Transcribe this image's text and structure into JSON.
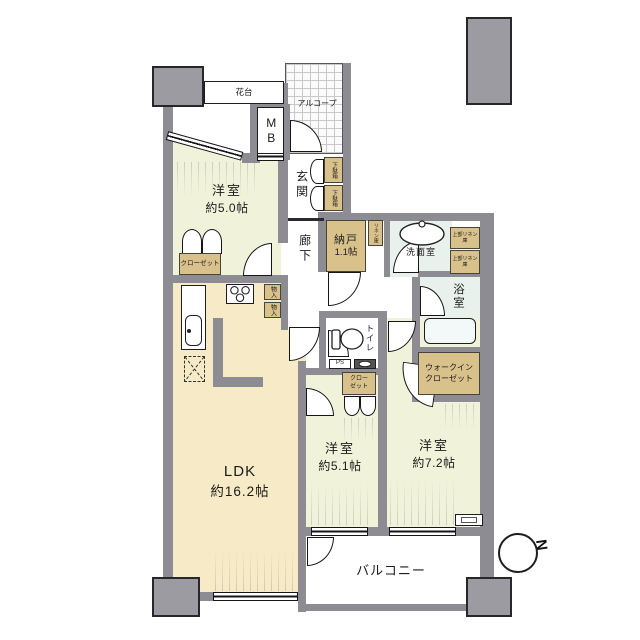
{
  "floorplan": {
    "rooms": {
      "western_5_0": {
        "label": "洋室",
        "size": "約5.0帖"
      },
      "western_5_1": {
        "label": "洋室",
        "size": "約5.1帖"
      },
      "western_7_2": {
        "label": "洋室",
        "size": "約7.2帖"
      },
      "ldk": {
        "label": "LDK",
        "size": "約16.2帖"
      },
      "storage_room": {
        "label": "納戸",
        "size": "1.1帖"
      },
      "entrance": {
        "label": "玄関"
      },
      "corridor": {
        "label": "廊下"
      },
      "washroom": {
        "label": "洗面室"
      },
      "bathroom": {
        "label": "浴室"
      },
      "toilet": {
        "label": "トイレ"
      },
      "balcony": {
        "label": "バルコニー"
      },
      "alcove": {
        "label": "アルコープ"
      },
      "flower_stand": {
        "label": "花台"
      },
      "meter_box": {
        "label": "MB"
      },
      "walk_in_closet": {
        "line1": "ウォークイン",
        "line2": "クローゼット"
      },
      "closet_5_0": {
        "label": "クローゼット"
      },
      "closet_5_1": {
        "line1": "クロー",
        "line2": "ゼット"
      },
      "shoe_box": {
        "label": "下駄箱"
      },
      "storage_small": {
        "label": "物入"
      },
      "linen": {
        "label": "リネン庫"
      },
      "upper_linen": {
        "line1": "上部リネン",
        "line2": "庫"
      },
      "pipe_space": {
        "label": "PS"
      }
    },
    "compass": {
      "north": "N"
    },
    "colors": {
      "wall": "#8c8c92",
      "bedroom": "#f0f3da",
      "ldk": "#f6ebc6",
      "storage": "#d9c18c",
      "wet_area": "#e9f1ec"
    }
  }
}
